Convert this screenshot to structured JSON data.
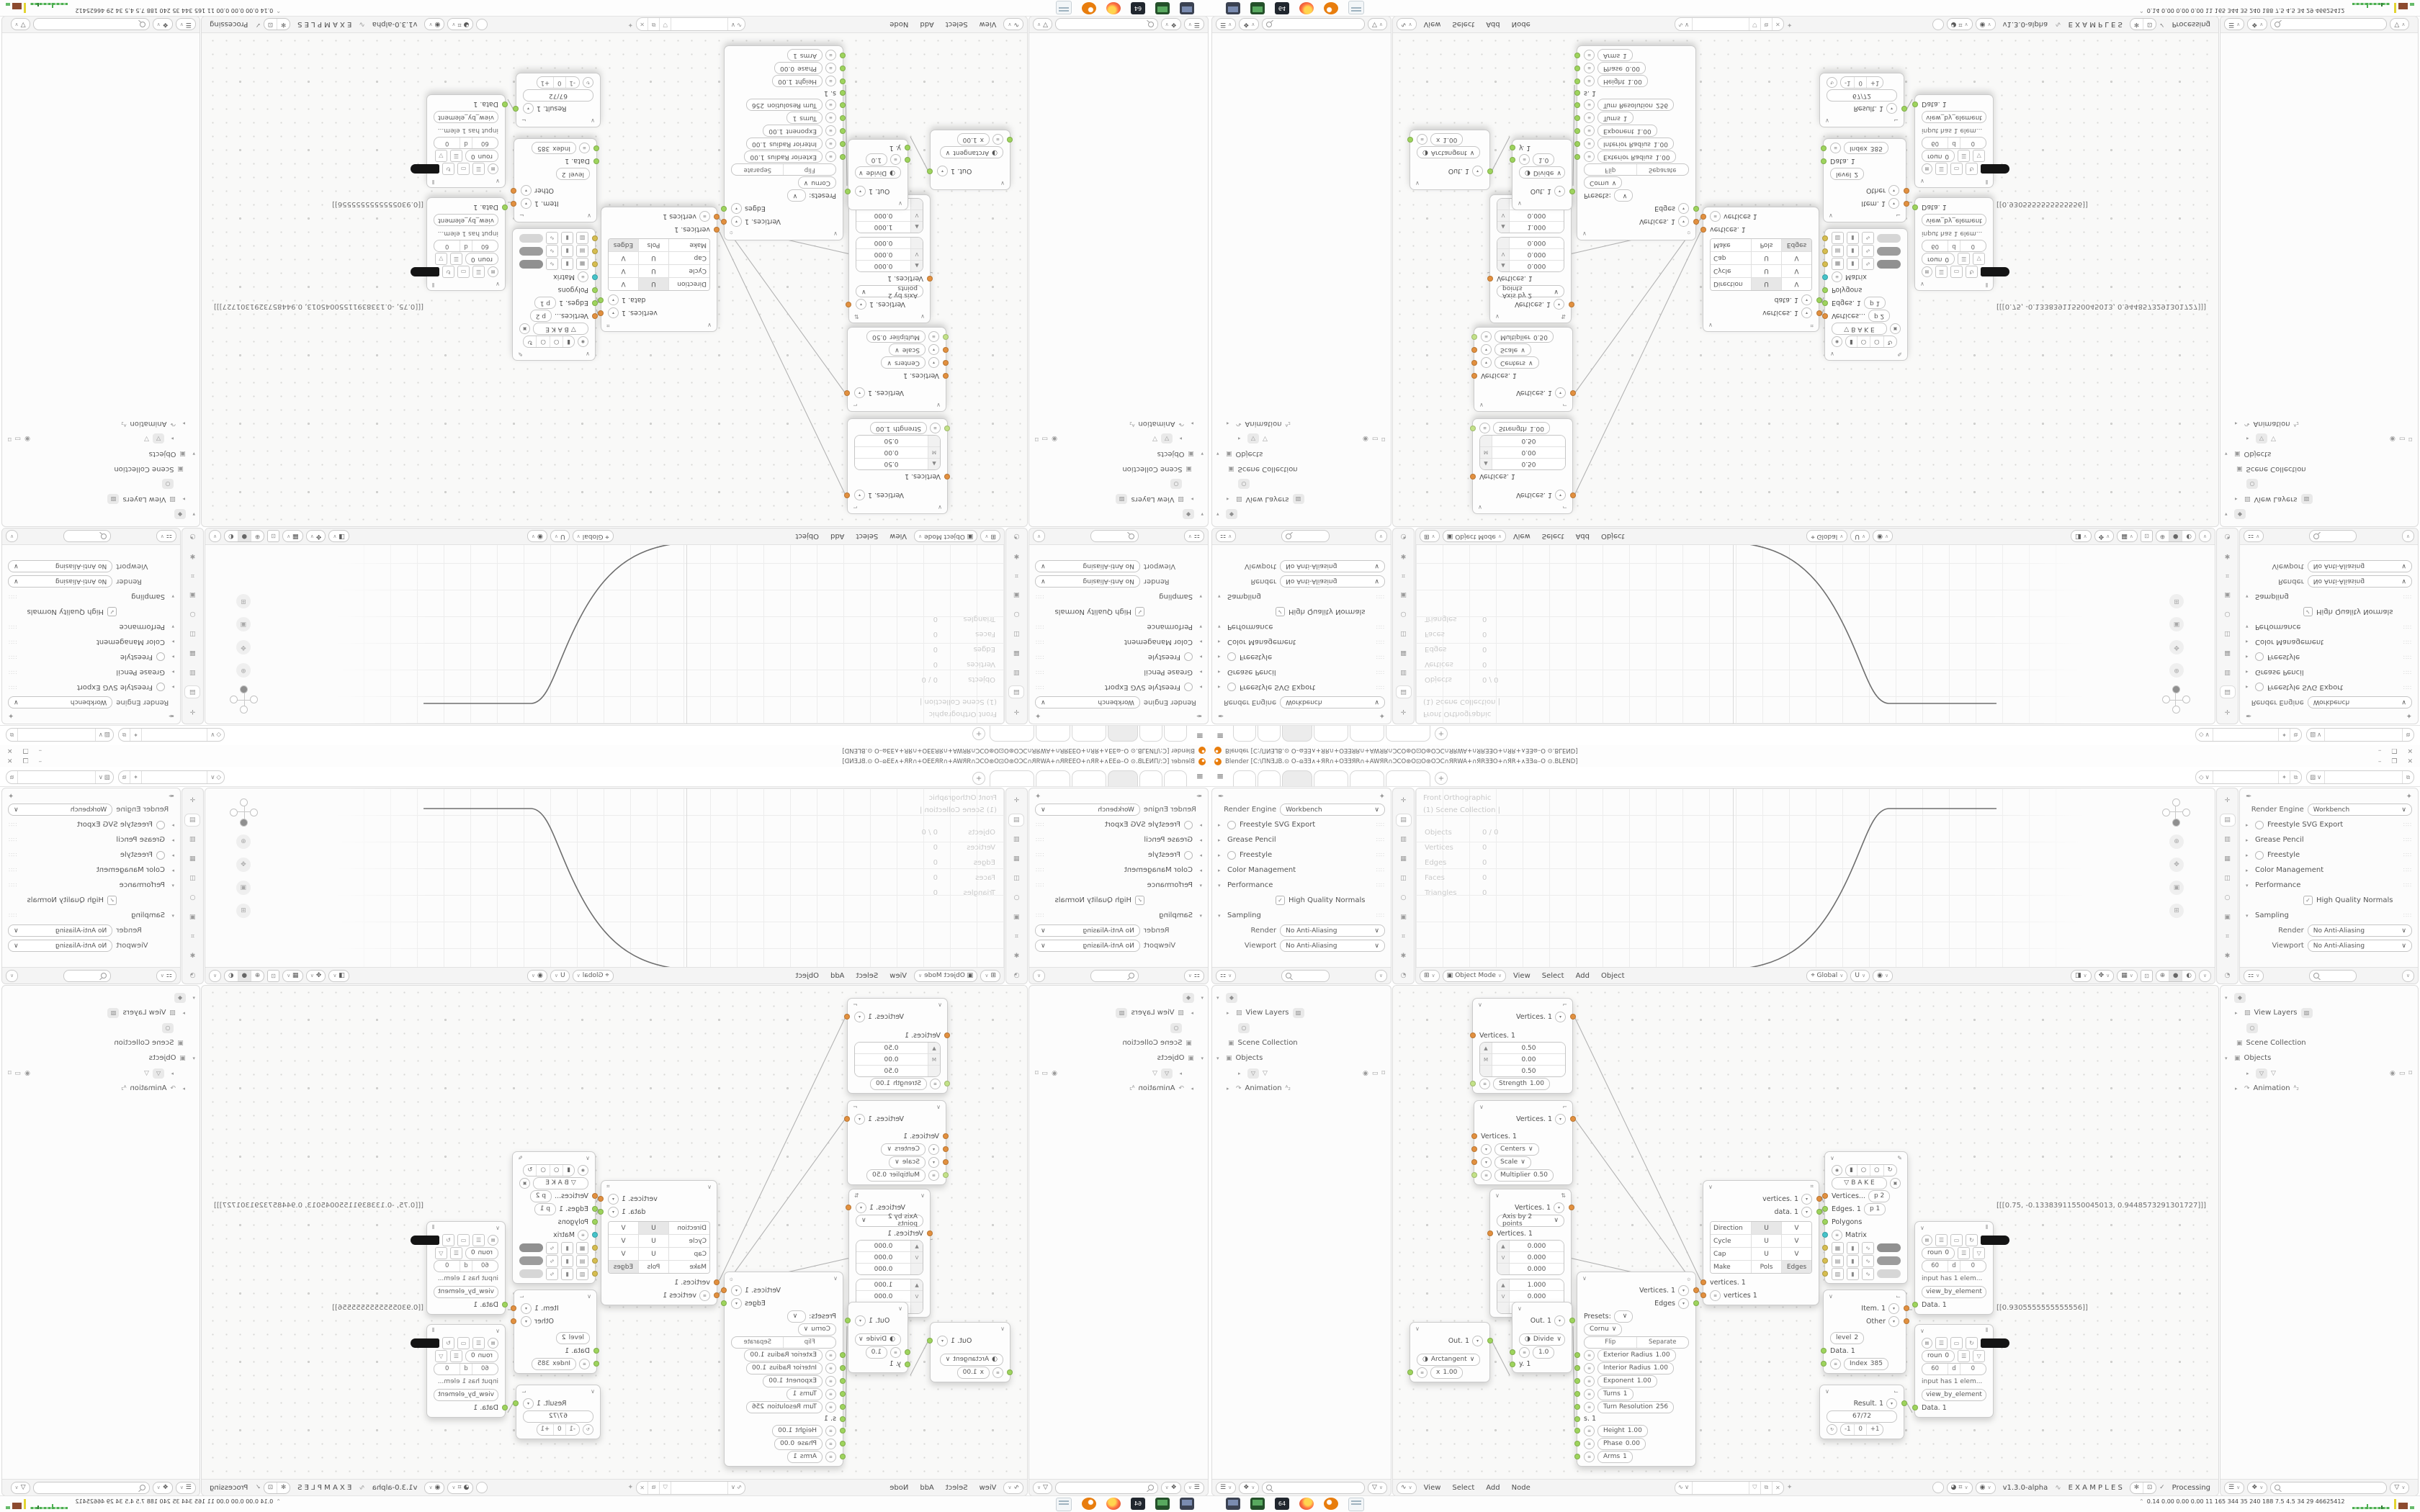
{
  "window": {
    "title": "Blender [C:\\ΠNƎ⅃B.⊙ O–ɷƎƎ∧+ЯR∩+OƎƎЯR∩+AWЯR∩ƆCO⊛O⊡O⊛OƆC∩ЯRWA+∩ЯRƎƎO+∩ЯR+∧ƎƎɷ–O ⊙.BLEND]",
    "minimize": "–",
    "restore": "❐",
    "close": "✕"
  },
  "tabs": {
    "add": "+"
  },
  "topbar": {
    "scene_icon": "◇",
    "layer_icon": "▨",
    "pin_icon": "✦",
    "copy_icon": "⧉"
  },
  "properties": {
    "render_engine_label": "Render Engine",
    "render_engine_value": "Workbench",
    "freestyle_svg": "Freestyle SVG Export",
    "grease_pencil": "Grease Pencil",
    "freestyle": "Freestyle",
    "color_management": "Color Management",
    "performance": "Performance",
    "hqn": "High Quality Normals",
    "sampling": "Sampling",
    "render_label": "Render",
    "render_value": "No Anti-Aliasing",
    "viewport_label": "Viewport",
    "viewport_value": "No Anti-Aliasing",
    "tab_icons": [
      "✛",
      "▤",
      "▥",
      "▦",
      "◫",
      "○",
      "▣",
      "⌗",
      "✱",
      "◔",
      "✎"
    ]
  },
  "viewport": {
    "overlay1": "Front Orthographic",
    "overlay2": "(1) Scene Collection |",
    "stats": {
      "objects_label": "Objects",
      "objects": "0 / 0",
      "vertices_label": "Vertices",
      "vertices": "0",
      "edges_label": "Edges",
      "edges": "0",
      "faces_label": "Faces",
      "faces": "0",
      "triangles_label": "Triangles",
      "triangles": "0"
    },
    "mode": "Object Mode",
    "menu_view": "View",
    "menu_select": "Select",
    "menu_add": "Add",
    "menu_object": "Object",
    "orientation": "Global",
    "gizmo_buttons": [
      "⊕",
      "✥",
      "▣",
      "⊞"
    ]
  },
  "outliner": {
    "view_layers": "View Layers",
    "scene_collection": "Scene Collection",
    "objects": "Objects",
    "animation": "Animation",
    "anim_badge": "ᴬ₂"
  },
  "node_editor": {
    "menu_view": "View",
    "menu_select": "Select",
    "menu_add": "Add",
    "menu_node": "Node",
    "version": "v1.3.0-alpha",
    "examples": "E X A M P L E S",
    "processing": "Processing",
    "value_triplet": "[[[0.75, -0.13383911550045013, 0.9448573291301727]]]",
    "value_single": "[[0.9305555555555556]]",
    "nodes": {
      "move": {
        "out": "Vertices. 1",
        "in": "Vertices. 1",
        "t1": "▲",
        "t2": "M",
        "t3": "",
        "v1": "0.50",
        "v2": "0.00",
        "v3": "0.50",
        "strength_label": "Strength",
        "strength": "1.00"
      },
      "scale": {
        "out": "Vertices. 1",
        "in": "Vertices. 1",
        "mode1": "Centers",
        "mode2": "Scale",
        "mult_label": "Multiplier",
        "mult": "0.50"
      },
      "axis": {
        "out": "Vertices. 1",
        "mode": "Axis by 2 points",
        "in": "Vertices. 1",
        "t1": "▲",
        "t2": "V",
        "t3": "",
        "a1": "0.000",
        "a2": "0.000",
        "a3": "0.000",
        "b1": "1.000",
        "b2": "0.000",
        "b3": "1.000"
      },
      "uvgrid": {
        "out1": "vertices. 1",
        "out2": "data. 1",
        "r1": "Direction",
        "r2": "Cycle",
        "r3": "Cap",
        "r4": "Make",
        "u": "U",
        "v": "V",
        "pols": "Pols",
        "edges": "Edges",
        "in1": "vertices. 1",
        "in2": "vertices 1"
      },
      "spiral": {
        "out1": "Vertices. 1",
        "out2": "Edges",
        "presets": "Presets:",
        "type": "Cornu",
        "flip": "Flip",
        "separate": "Separate",
        "p1l": "Exterior Radius",
        "p1": "1.00",
        "p2l": "Interior Radius",
        "p2": "1.00",
        "p3l": "Exponent",
        "p3": "1.00",
        "p4l": "Turns",
        "p4": "1",
        "p5l": "Turn Resolution",
        "p5": "256",
        "s": "s. 1",
        "p6l": "Height",
        "p6": "1.00",
        "p7l": "Phase",
        "p7": "0.00",
        "p8l": "Arms",
        "p8": "1"
      },
      "arctangent": {
        "out": "Out. 1",
        "fn": "Arctangent",
        "xl": "x",
        "x": "1.00"
      },
      "divide": {
        "out": "Out. 1",
        "fn": "Divide",
        "val": "1.0",
        "y": "y. 1"
      },
      "viewer": {
        "bake": "B A K E",
        "in1": "Vertices...",
        "b1": "p  2",
        "in2": "Edges. 1",
        "b2": "p  1",
        "in3": "Polygons",
        "in4": "Matrix"
      },
      "list_item": {
        "out1": "Item. 1",
        "out2": "Other",
        "level_label": "level",
        "level": "2",
        "in": "Data. 1",
        "index_label": "Index",
        "index": "385"
      },
      "number": {
        "out": "Result. 1",
        "value": "67/72",
        "minus": "-1",
        "zero": "0",
        "plus": "+1"
      },
      "stethoscope": {
        "f1": "roun",
        "f1v": "0",
        "f2": "60",
        "f3": "d",
        "f3v": "0",
        "info": "input has 1 elem...",
        "mode": "view_by_element",
        "in": "Data. 1"
      }
    }
  },
  "taskbar": {
    "floppy": "64",
    "stats": "0.14 0.00 0.00 0.00   11   165   344   35   240   188   7.5   4.5   34   29   46625412"
  }
}
